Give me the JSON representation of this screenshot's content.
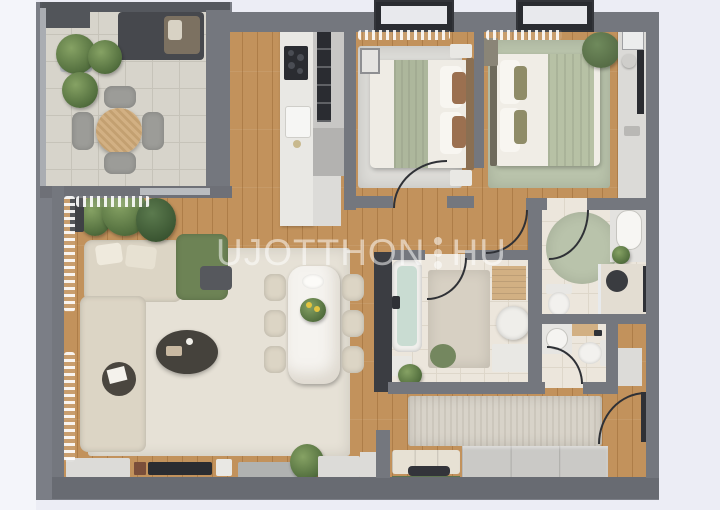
{
  "meta": {
    "title": "Apartment floor plan – 3D top-down render",
    "view": "top-down"
  },
  "watermark": {
    "text_left": "UJOTTHON",
    "text_right": "HU",
    "separator": "three-vertical-dots",
    "color": "#ffffff",
    "opacity": 0.52
  },
  "rooms": [
    {
      "id": "terrace",
      "label": "Terrace with outdoor lounge, round table and plants"
    },
    {
      "id": "living-room",
      "label": "Living room with L-shaped sofa, green armchair and coffee table"
    },
    {
      "id": "kitchen",
      "label": "Kitchen with counter, cooktop, sink and appliance column"
    },
    {
      "id": "dining-area",
      "label": "Dining area with marble table and six chairs"
    },
    {
      "id": "bedroom-1",
      "label": "Bedroom 1 with double bed and nightstands"
    },
    {
      "id": "bedroom-2",
      "label": "Bedroom 2 with double bed, pouf and vanity desk"
    },
    {
      "id": "bathroom",
      "label": "Bathroom with bathtub"
    },
    {
      "id": "shower-room",
      "label": "Shower room with washbasin, toilet and round rug"
    },
    {
      "id": "wc",
      "label": "WC with toilet and washbasin"
    },
    {
      "id": "entrance-hall",
      "label": "Entrance hall with runner rug, wardrobe and shoe bench"
    },
    {
      "id": "corridor",
      "label": "Corridor"
    }
  ],
  "palette": {
    "bg": "#ecedf5",
    "bgLeft": "#f4f5fa",
    "base": "#7b7e86",
    "wall": "#74777e",
    "wallDark": "#55585e",
    "glassWall": "#3b3d42",
    "wallLight": "#aaadb2",
    "wood": "#c2925c",
    "stone": "#d7d4cb",
    "stoneLine": "#c6c3b9",
    "tile": "#ece6dc",
    "tileLine": "#ded7ca",
    "rugCream": "#e6e1d6",
    "rugMarble": "#dcdbd7",
    "rugSage": "#b9c3ab",
    "sofa": "#dcd5c5",
    "chairGreen": "#6d8355",
    "darkWood": "#45423c",
    "appliance": "#2a2c31",
    "whiteFurn": "#e9e8e4",
    "marble": "#f5f3ef",
    "tubWater": "#c9dcd2",
    "woodFurn": "#d2b083",
    "console": "#dcdbd8",
    "stoneBench": "#b0b2b1",
    "arcLine": "#2f3136",
    "curtain": "#ffffff",
    "plantA": "#86a264",
    "plantB": "#54703f",
    "lounge": "#46484d",
    "loungeCushion": "#7c7161"
  }
}
